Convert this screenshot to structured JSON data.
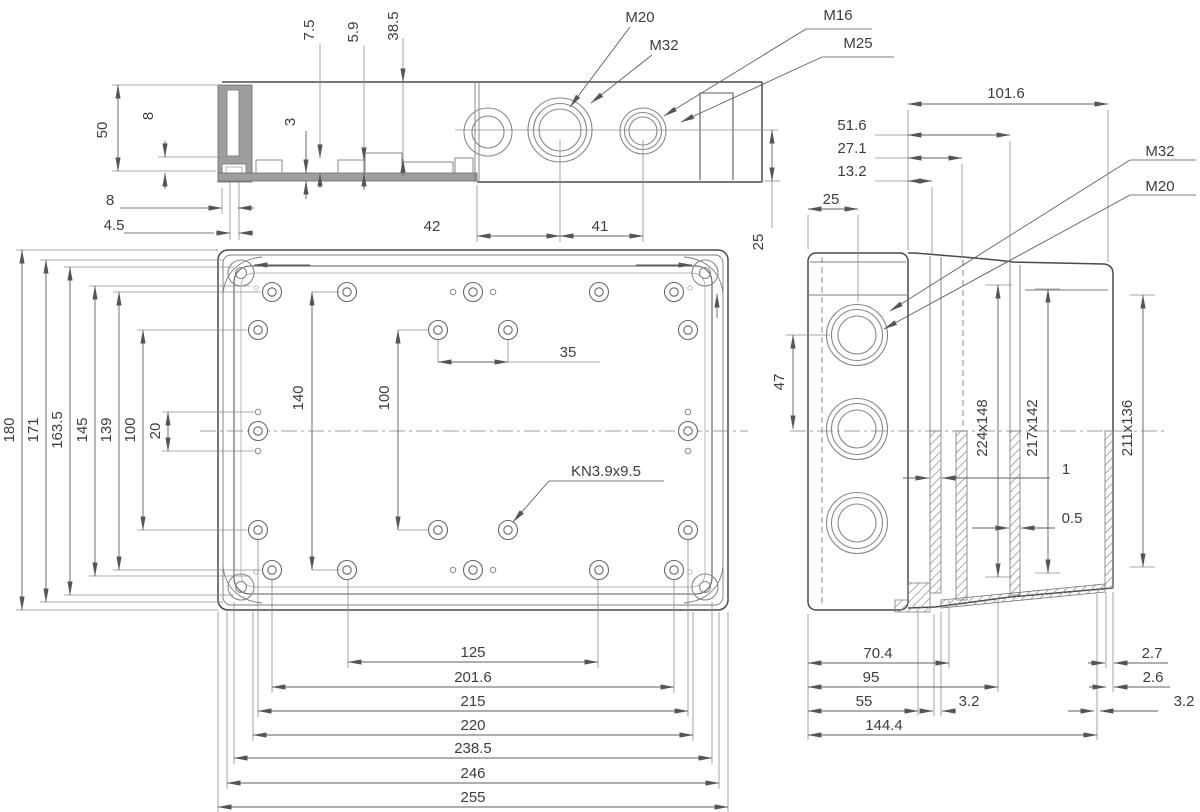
{
  "drawing": {
    "top_view": {
      "m20": "M20",
      "m32": "M32",
      "m16": "M16",
      "m25": "M25",
      "d7_5": "7.5",
      "d5_9": "5.9",
      "d38_5": "38.5",
      "d50": "50",
      "d8_depth": "8",
      "d3": "3",
      "d8_bottom": "8",
      "d4_5": "4.5",
      "d42": "42",
      "d41": "41",
      "d25": "25"
    },
    "front_view": {
      "d180": "180",
      "d171": "171",
      "d163_5": "163.5",
      "d145": "145",
      "d139": "139",
      "d100_left": "100",
      "d20": "20",
      "d140": "140",
      "d100_inner": "100",
      "d35": "35",
      "kn_label": "KN3.9x9.5",
      "d125": "125",
      "d201_6": "201.6",
      "d215": "215",
      "d220": "220",
      "d238_5": "238.5",
      "d246": "246",
      "d255": "255"
    },
    "side_view": {
      "d101_6": "101.6",
      "d51_6": "51.6",
      "d27_1": "27.1",
      "d13_2": "13.2",
      "d25": "25",
      "m32": "M32",
      "m20": "M20",
      "d47": "47",
      "d224x148": "224x148",
      "d217x142": "217x142",
      "d211x136": "211x136",
      "d1": "1",
      "d0_5": "0.5",
      "d70_4": "70.4",
      "d95": "95",
      "d55": "55",
      "d3_2_wall": "3.2",
      "d144_4": "144.4",
      "d2_7": "2.7",
      "d2_6": "2.6",
      "d3_2_right": "3.2"
    }
  }
}
